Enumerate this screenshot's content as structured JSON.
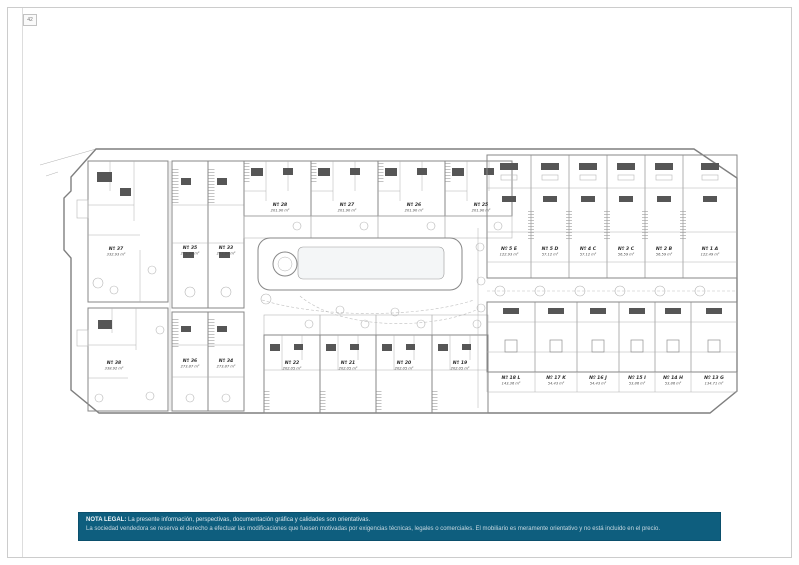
{
  "page": {
    "number": "42"
  },
  "plan": {
    "units": [
      {
        "id": "Nº 37",
        "area": "332.93 m²"
      },
      {
        "id": "Nº 35",
        "area": "273.84 m²"
      },
      {
        "id": "Nº 33",
        "area": "273.84 m²"
      },
      {
        "id": "Nº 28",
        "area": "201.90 m²"
      },
      {
        "id": "Nº 27",
        "area": "201.90 m²"
      },
      {
        "id": "Nº 26",
        "area": "201.90 m²"
      },
      {
        "id": "Nº 25",
        "area": "201.90 m²"
      },
      {
        "id": "Nº 5 E",
        "area": "122.93 m²"
      },
      {
        "id": "Nº 5 D",
        "area": "57.12 m²"
      },
      {
        "id": "Nº 4 C",
        "area": "57.12 m²"
      },
      {
        "id": "Nº 3 C",
        "area": "56.59 m²"
      },
      {
        "id": "Nº 2 B",
        "area": "56.59 m²"
      },
      {
        "id": "Nº 1 A",
        "area": "122.49 m²"
      },
      {
        "id": "Nº 38",
        "area": "338.92 m²"
      },
      {
        "id": "Nº 36",
        "area": "273.87 m²"
      },
      {
        "id": "Nº 34",
        "area": "273.87 m²"
      },
      {
        "id": "Nº 22",
        "area": "202.05 m²"
      },
      {
        "id": "Nº 21",
        "area": "202.05 m²"
      },
      {
        "id": "Nº 20",
        "area": "202.05 m²"
      },
      {
        "id": "Nº 19",
        "area": "202.05 m²"
      },
      {
        "id": "Nº 18 L",
        "area": "143.36 m²"
      },
      {
        "id": "Nº 17 K",
        "area": "54.43 m²"
      },
      {
        "id": "Nº 16 J",
        "area": "54.43 m²"
      },
      {
        "id": "Nº 15 I",
        "area": "53.86 m²"
      },
      {
        "id": "Nº 14 H",
        "area": "53.86 m²"
      },
      {
        "id": "Nº 13 G",
        "area": "134.71 m²"
      }
    ]
  },
  "legal_note": {
    "title": "NOTA LEGAL:",
    "line1": "La presente información, perspectivas, documentación gráfica y calidades son orientativas.",
    "line2": "La sociedad vendedora se reserva el derecho a efectuar las modificaciones que fuesen motivadas por exigencias técnicas, legales o comerciales. El mobiliario es meramente orientativo y no está incluido en el precio."
  },
  "colors": {
    "note_background": "#0e5e7e",
    "note_text": "#dce8ee",
    "plan_line": "#878787",
    "page_background": "#ffffff"
  }
}
